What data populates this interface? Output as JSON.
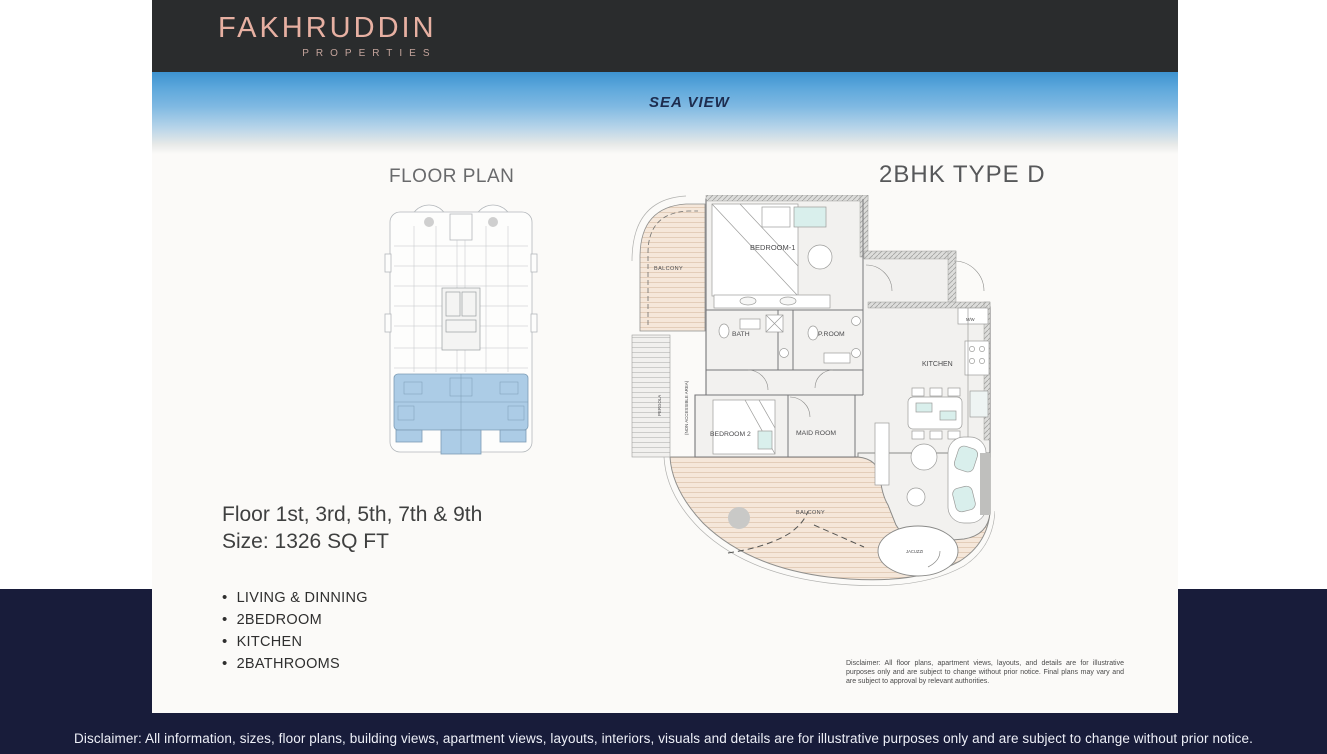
{
  "header": {
    "brand": "FAKHRUDDIN",
    "brand_sub": "PROPERTIES"
  },
  "hero": {
    "sea_view_label": "SEA VIEW"
  },
  "key_plan": {
    "title": "FLOOR PLAN"
  },
  "unit": {
    "title": "2BHK TYPE D",
    "floor_line": "Floor 1st, 3rd, 5th, 7th & 9th",
    "size_line": "Size: 1326 SQ FT",
    "features": [
      "LIVING & DINNING",
      "2BEDROOM",
      "KITCHEN",
      "2BATHROOMS"
    ]
  },
  "plan_labels": {
    "balcony_top": "BALCONY",
    "bedroom1": "BEDROOM-1",
    "bath": "BATH",
    "proom": "P.ROOM",
    "kitchen": "KITCHEN",
    "mw": "M/W",
    "bedroom2": "BEDROOM 2",
    "maid_room": "MAID ROOM",
    "balcony_bottom": "BALCONY",
    "jacuzzi": "JACUZZI",
    "pergola_line1": "PERGOLA",
    "pergola_line2": "(NON ACCESSIBLE AREA)"
  },
  "plan_disclaimer": {
    "line1": "Disclaimer: All floor plans, apartment views, layouts, and details are for illustrative purposes only and are subject to change without prior notice. Final plans may vary and are subject to approval by relevant authorities."
  },
  "footer": {
    "disclaimer": "Disclaimer: All information, sizes, floor plans, building views, apartment views, layouts, interiors, visuals and details are for illustrative purposes only and are subject to change without prior notice."
  },
  "colors": {
    "navy": "#181c3a",
    "header_bg": "#2a2c2d",
    "brand_pink": "#e7b0a2",
    "plan_highlight_blue": "#accce6",
    "balcony_tan": "#f5e7da",
    "sea_blue_top": "#3d92cf"
  }
}
